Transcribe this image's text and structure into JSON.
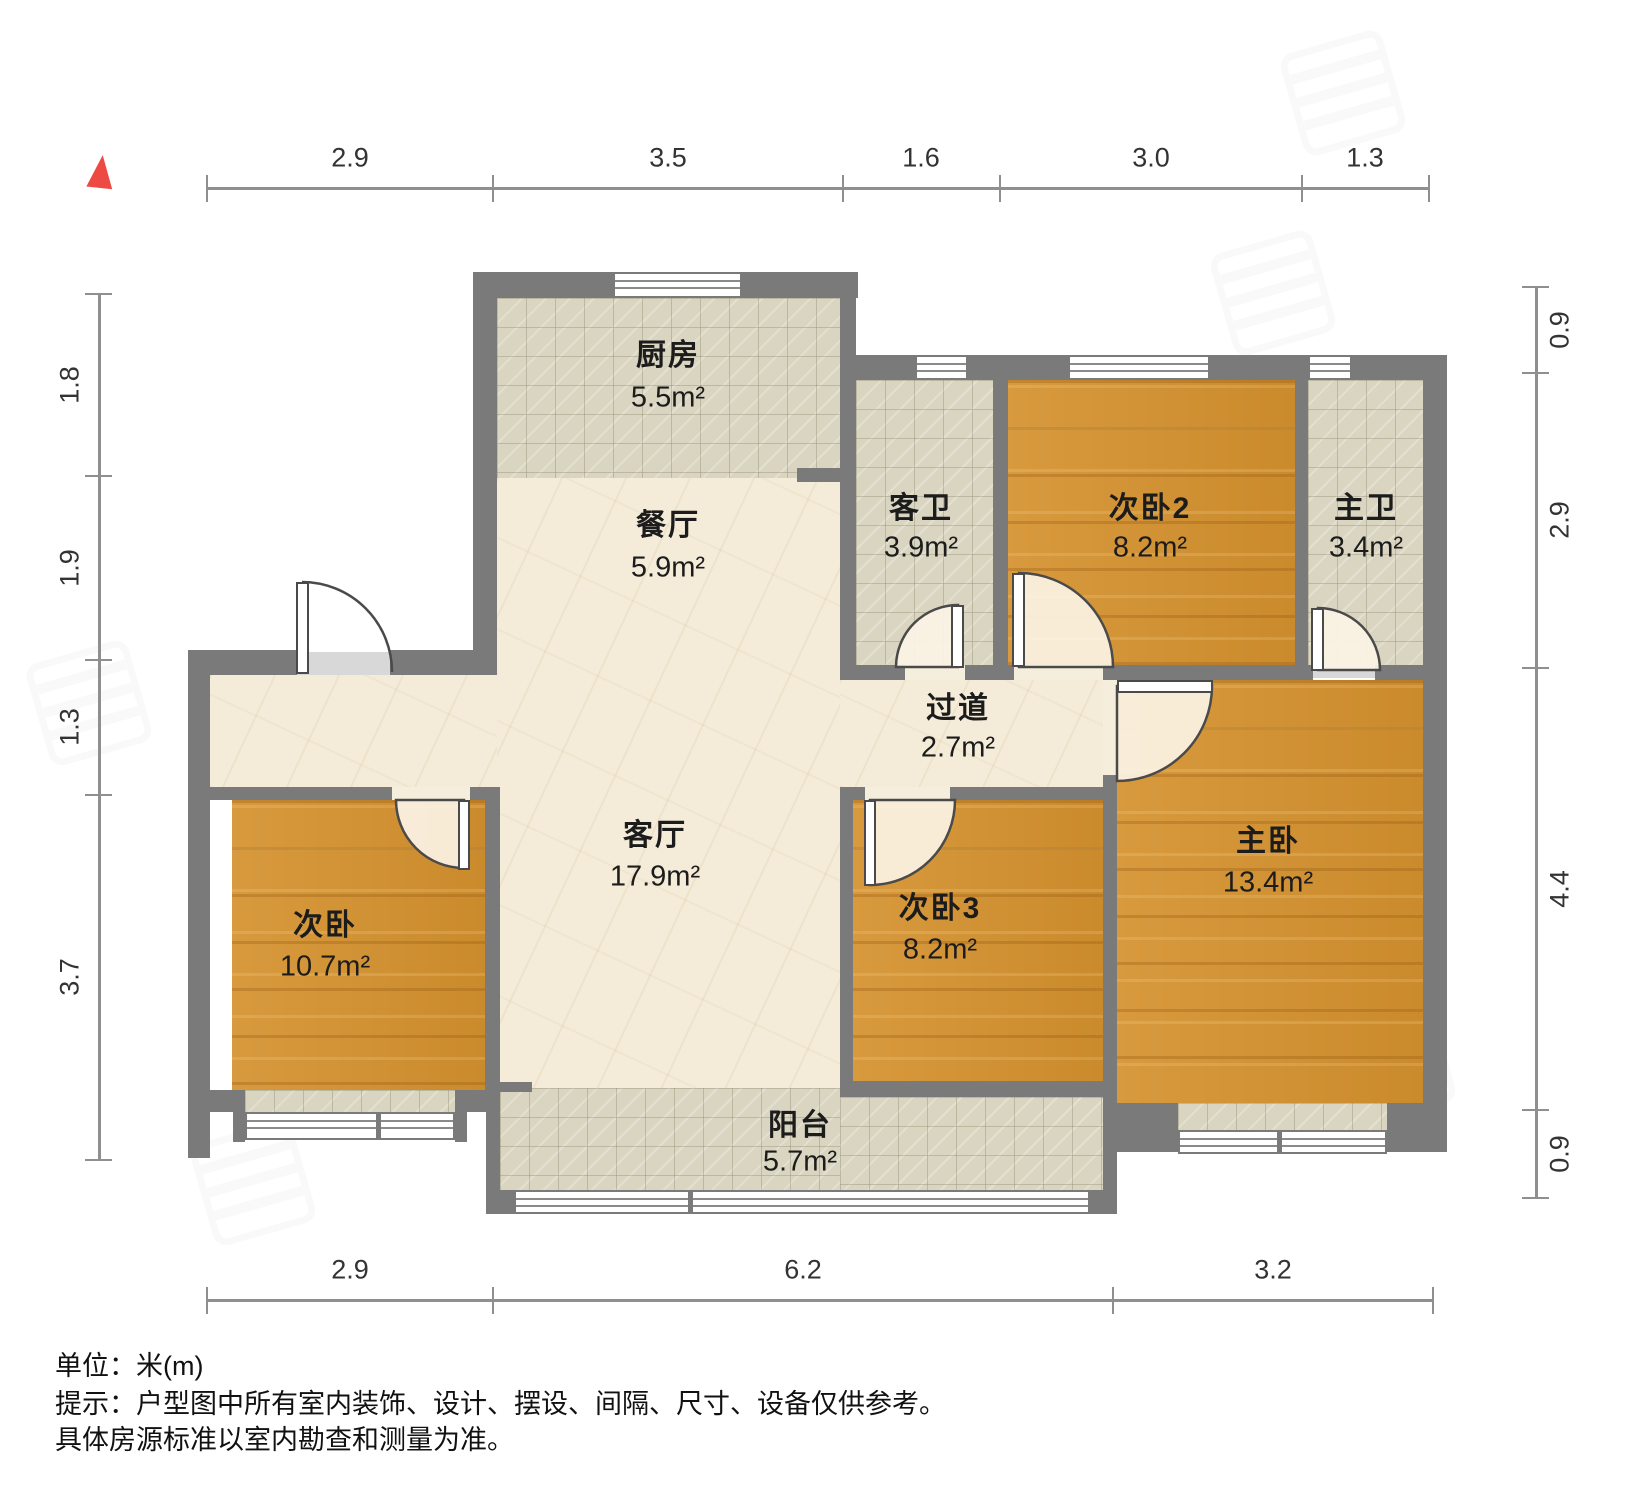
{
  "meta": {
    "type": "apartment-floor-plan",
    "unit_system_note": "单位：米(m)"
  },
  "icons": {
    "north": "north-arrow"
  },
  "colors": {
    "wall": "#7a7a7a",
    "wood_floor": "#d5922f",
    "tile_floor": "#d9d5c0",
    "marble_floor": "#f4ecd9",
    "north_arrow": "#ee4a44",
    "dimension": "#8f8f8f"
  },
  "rooms": {
    "kitchen": {
      "name": "厨房",
      "area": "5.5m²"
    },
    "dining": {
      "name": "餐厅",
      "area": "5.9m²"
    },
    "guest_bath": {
      "name": "客卫",
      "area": "3.9m²"
    },
    "bedroom2": {
      "name": "次卧2",
      "area": "8.2m²"
    },
    "master_bath": {
      "name": "主卫",
      "area": "3.4m²"
    },
    "hallway": {
      "name": "过道",
      "area": "2.7m²"
    },
    "living": {
      "name": "客厅",
      "area": "17.9m²"
    },
    "bedroom3": {
      "name": "次卧3",
      "area": "8.2m²"
    },
    "master_bedroom": {
      "name": "主卧",
      "area": "13.4m²"
    },
    "bedroom": {
      "name": "次卧",
      "area": "10.7m²"
    },
    "balcony": {
      "name": "阳台",
      "area": "5.7m²"
    }
  },
  "dims": {
    "top": [
      "2.9",
      "3.5",
      "1.6",
      "3.0",
      "1.3"
    ],
    "left": [
      "1.8",
      "1.9",
      "1.3",
      "3.7"
    ],
    "right": [
      "0.9",
      "2.9",
      "4.4",
      "0.9"
    ],
    "bottom": [
      "2.9",
      "6.2",
      "3.2"
    ]
  },
  "footer": {
    "line1": "单位：米(m)",
    "line2": "提示：户型图中所有室内装饰、设计、摆设、间隔、尺寸、设备仅供参考。",
    "line3": "具体房源标准以室内勘查和测量为准。"
  }
}
